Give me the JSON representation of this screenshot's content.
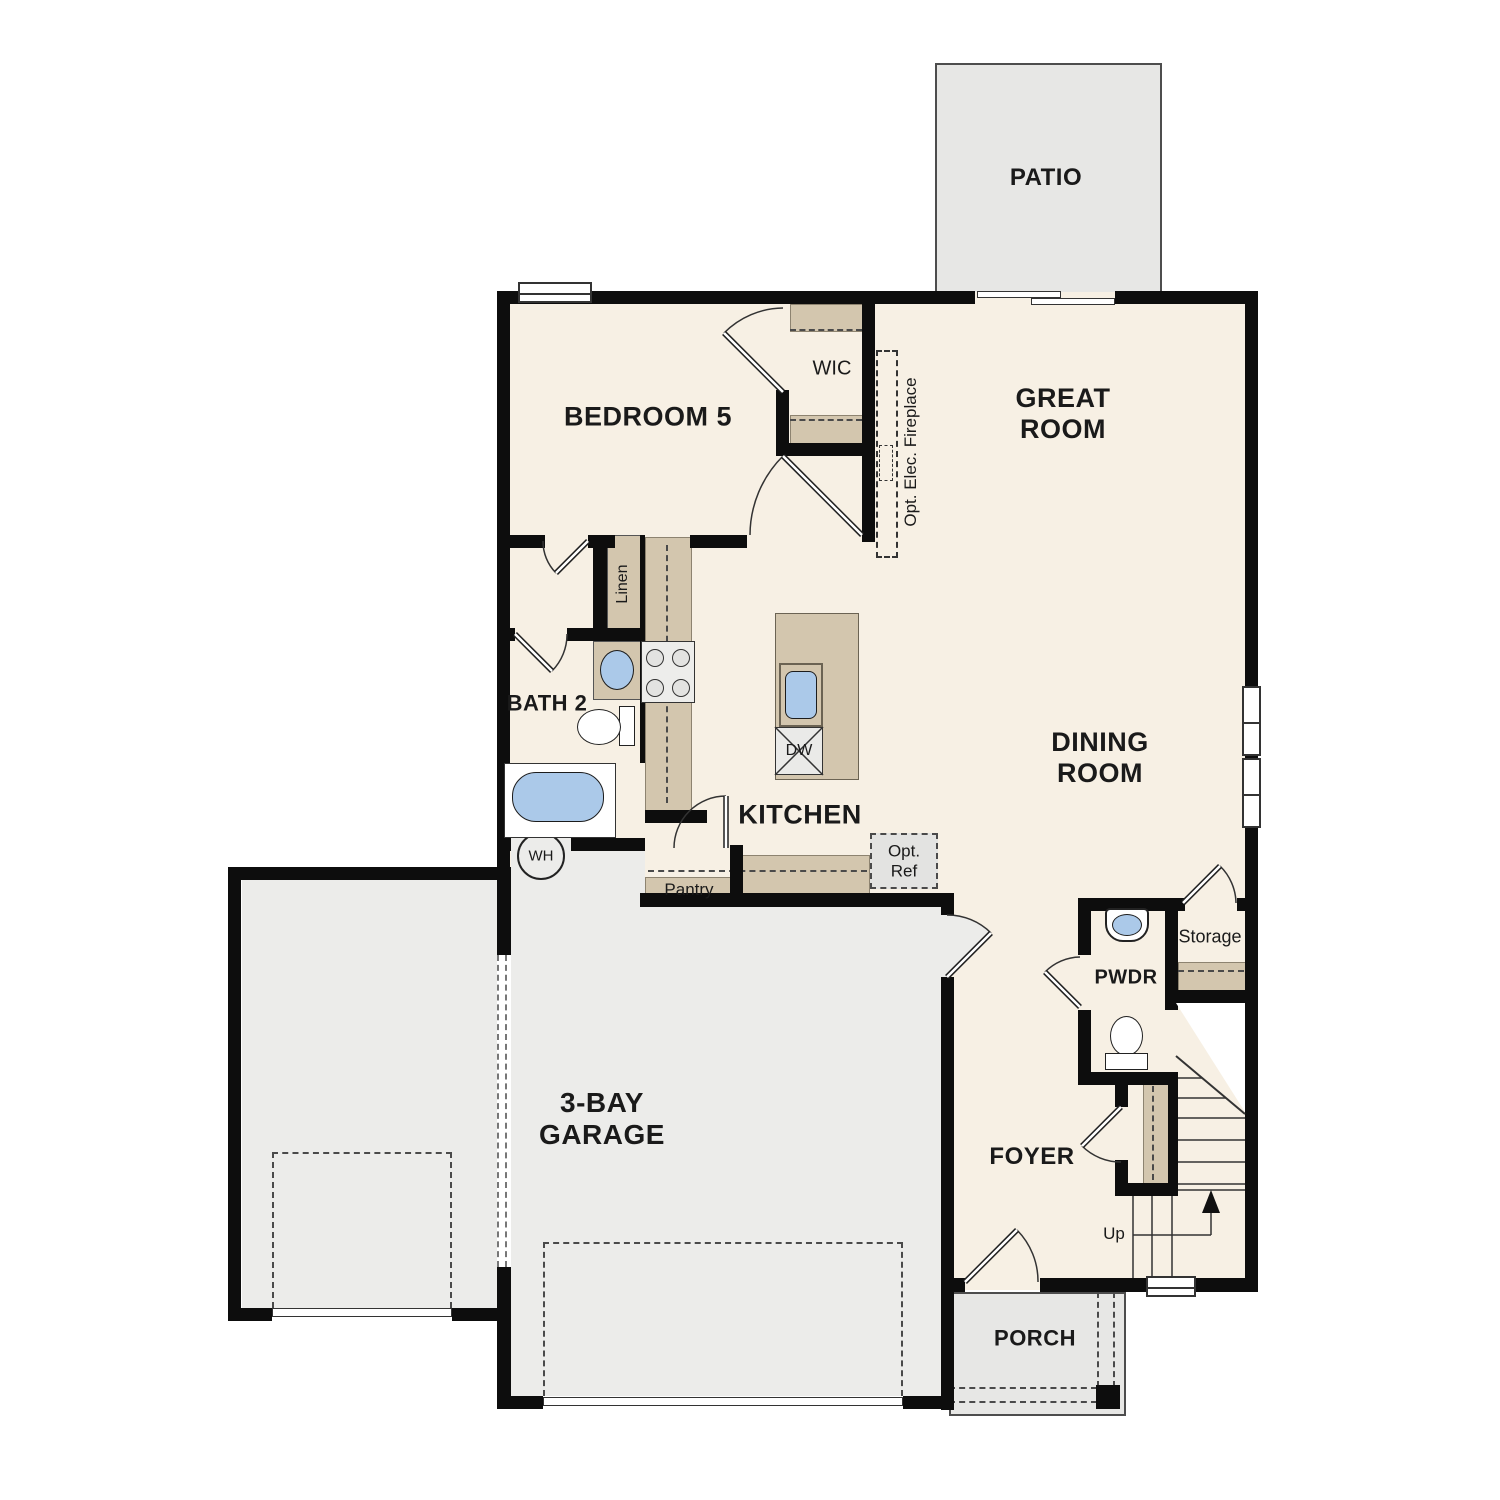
{
  "labels": {
    "patio": "PATIO",
    "bedroom5": "BEDROOM 5",
    "wic": "WIC",
    "great_room": [
      "GREAT",
      "ROOM"
    ],
    "opt_fireplace": "Opt. Elec. Fireplace",
    "linen": "Linen",
    "bath2": "BATH 2",
    "kitchen": "KITCHEN",
    "pantry": "Pantry",
    "dw": "DW",
    "opt_ref": [
      "Opt.",
      "Ref"
    ],
    "dining_room": [
      "DINING",
      "ROOM"
    ],
    "garage": [
      "3-BAY",
      "GARAGE"
    ],
    "wh": "WH",
    "pwdr": "PWDR",
    "storage": "Storage",
    "foyer": "FOYER",
    "up": "Up",
    "porch": "PORCH"
  },
  "colors": {
    "wall": "#0d0d0d",
    "floor": "#f7f0e4",
    "cabinet": "#d3c6ae",
    "blue": "#abc9e9",
    "garage": "#ececea",
    "outdoor": "#e7e7e5",
    "dash": "#4a4a4a",
    "line": "#333333"
  }
}
